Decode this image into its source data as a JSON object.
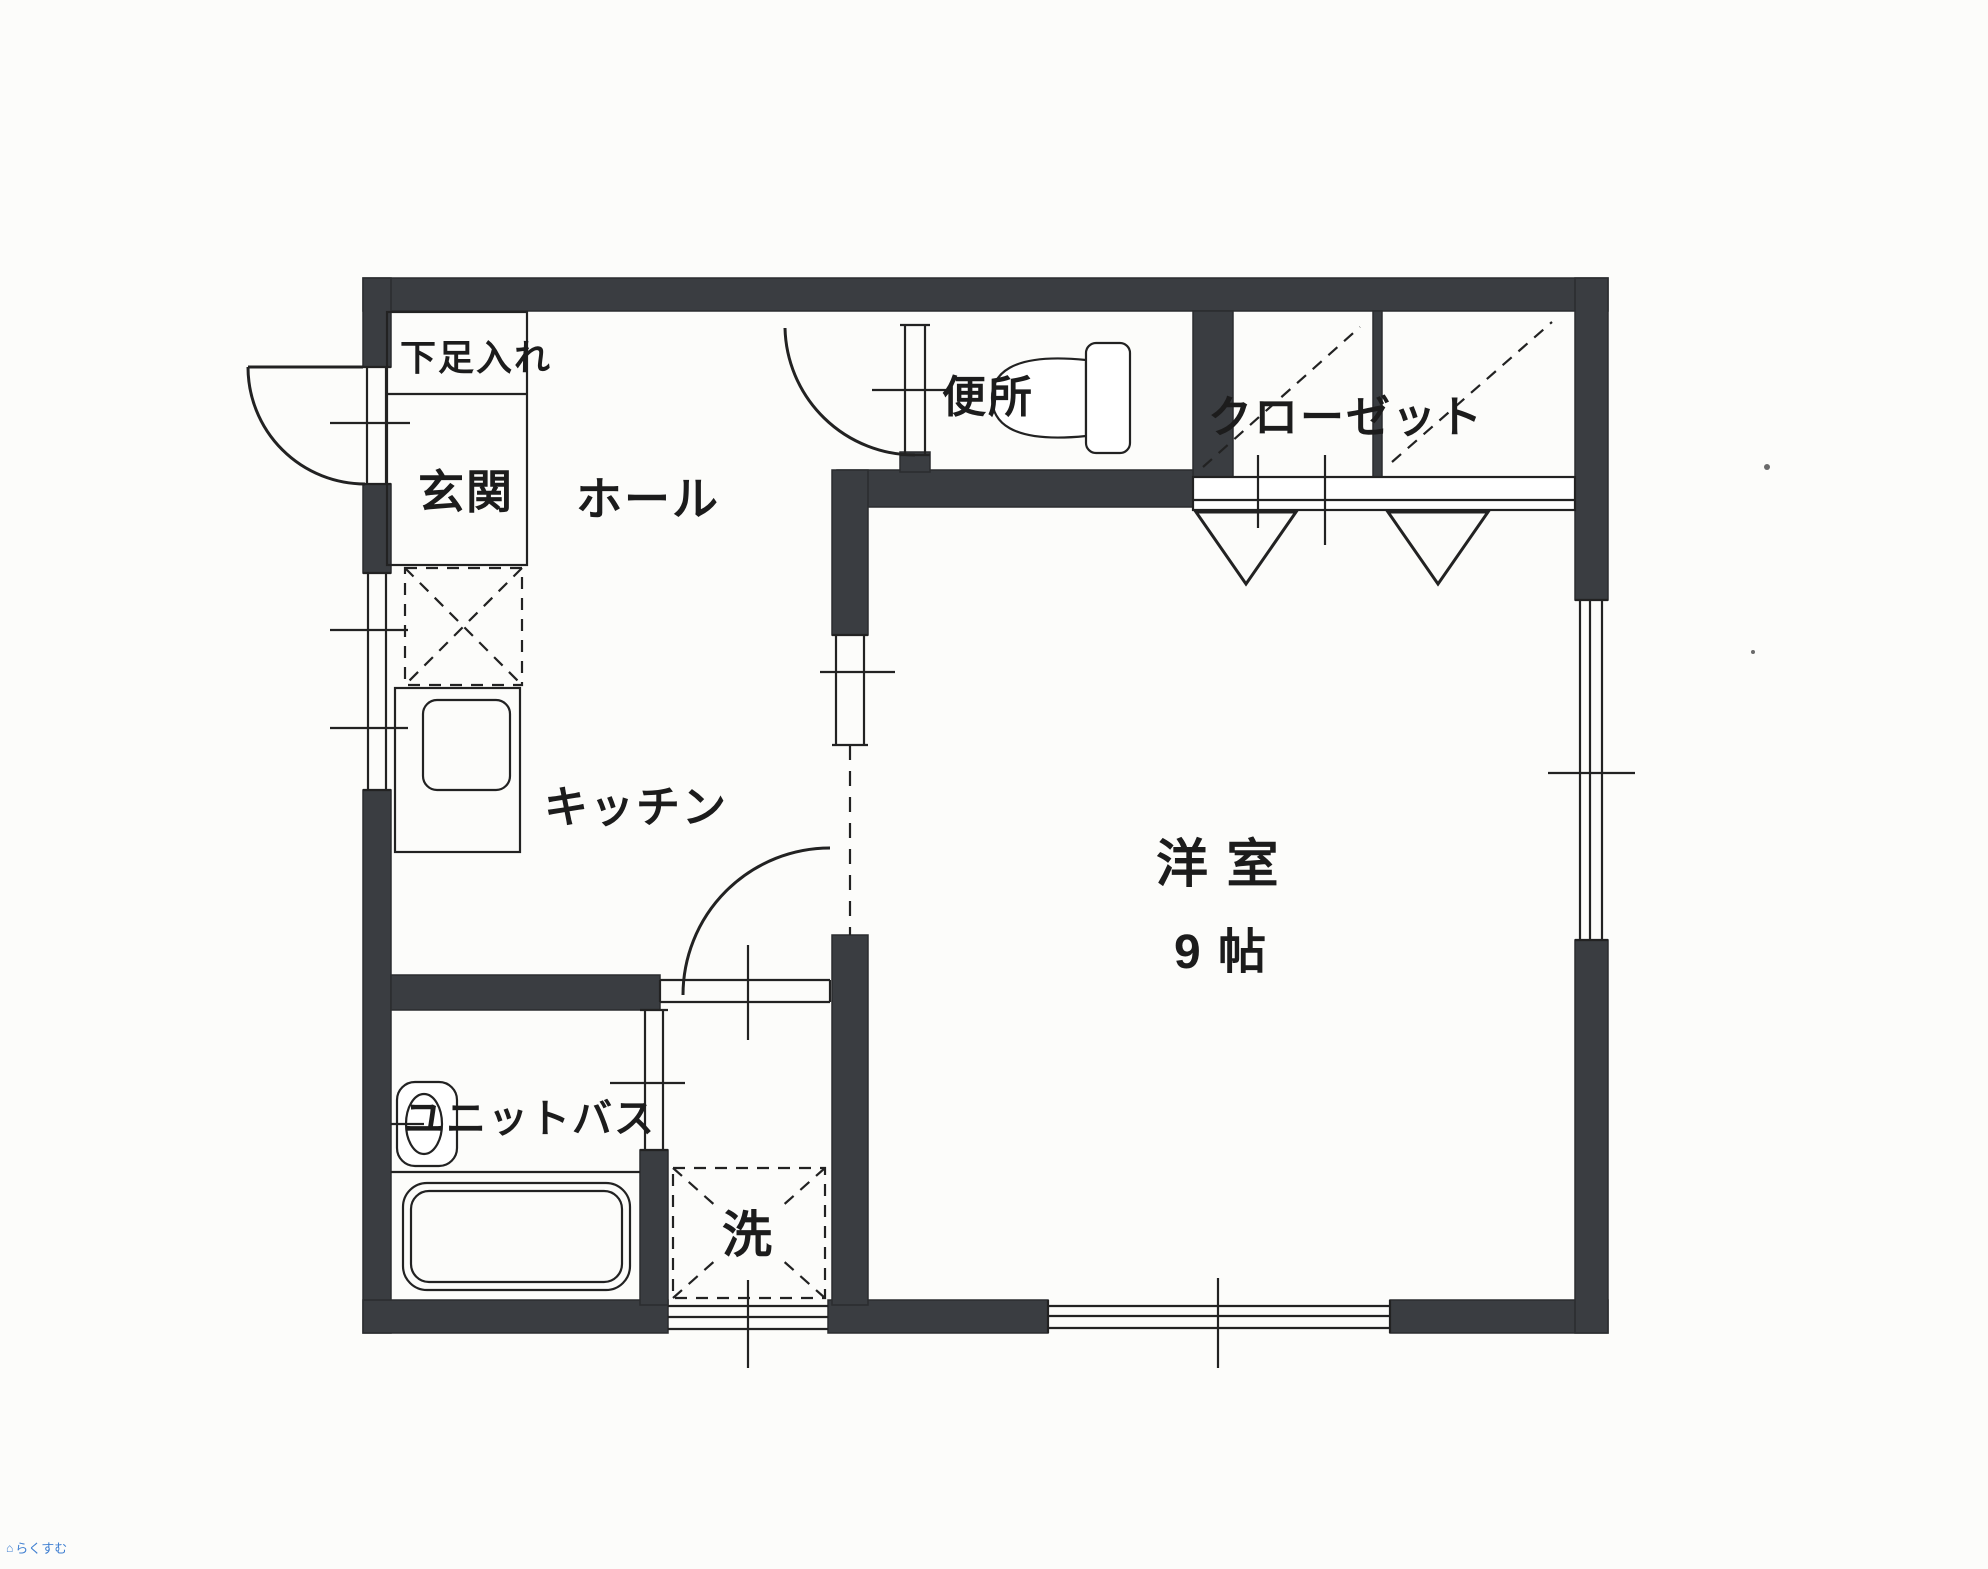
{
  "floorplan": {
    "rooms": {
      "shoe_storage": {
        "label": "下足入れ"
      },
      "entrance": {
        "label": "玄関"
      },
      "hall": {
        "label": "ホール"
      },
      "kitchen": {
        "label": "キッチン"
      },
      "toilet": {
        "label": "便所"
      },
      "closet": {
        "label": "クローゼット"
      },
      "western_room": {
        "label": "洋 室",
        "size": "9 帖"
      },
      "unit_bath": {
        "label": "ユニットバス"
      },
      "laundry": {
        "label": "洗"
      }
    }
  },
  "watermark": {
    "text": "らくすむ",
    "icon": "house-icon"
  },
  "colors": {
    "wall": "#3a3d41",
    "line": "#222222",
    "paper": "#fcfcfa",
    "label": "#1c1c1c",
    "watermark_blue": "#3f7fd1"
  }
}
